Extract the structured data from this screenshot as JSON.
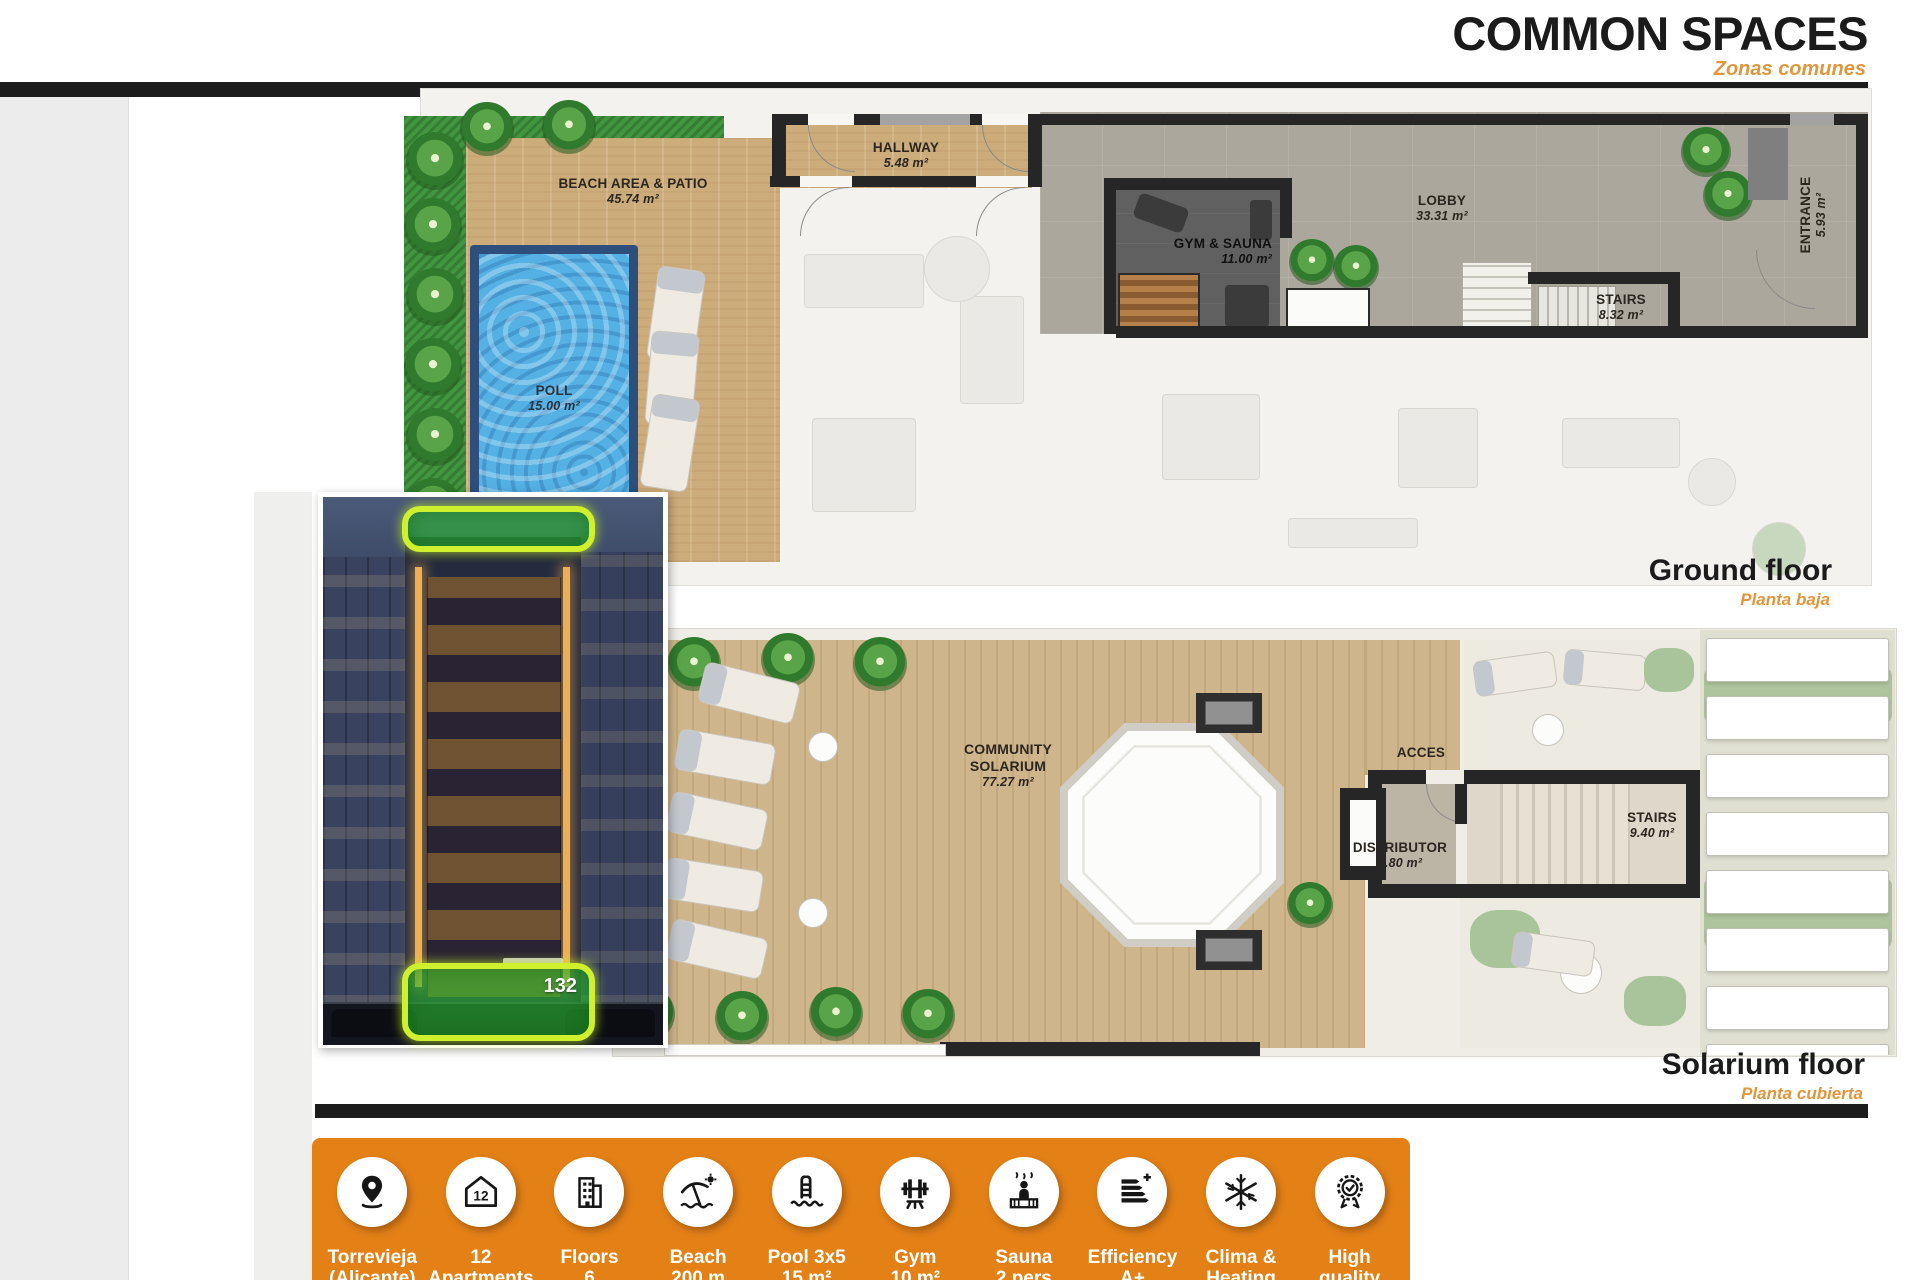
{
  "header": {
    "title": "COMMON SPACES",
    "subtitle": "Zonas comunes"
  },
  "ground_floor": {
    "caption": "Ground floor",
    "caption_es": "Planta baja",
    "rooms": {
      "beach": {
        "name": "BEACH AREA & PATIO",
        "area": "45.74 m²"
      },
      "pool": {
        "name": "POLL",
        "area": "15.00 m²"
      },
      "hallway": {
        "name": "HALLWAY",
        "area": "5.48 m²"
      },
      "gym": {
        "name": "GYM & SAUNA",
        "area": "11.00 m²"
      },
      "lobby": {
        "name": "LOBBY",
        "area": "33.31 m²"
      },
      "stairs": {
        "name": "STAIRS",
        "area": "8.32 m²"
      },
      "entrance": {
        "name": "ENTRANCE",
        "area": "5.93 m²"
      }
    }
  },
  "solarium_floor": {
    "caption": "Solarium floor",
    "caption_es": "Planta cubierta",
    "rooms": {
      "solarium": {
        "name": "COMMUNITY SOLARIUM",
        "area": "77.27 m²"
      },
      "acces": {
        "name": "ACCES"
      },
      "distributor": {
        "name": "DISTRIBUTOR",
        "area": "7.80 m²"
      },
      "stairs": {
        "name": "STAIRS",
        "area": "9.40 m²"
      }
    }
  },
  "photo": {
    "highlight_number": "132"
  },
  "features": [
    {
      "icon": "location-pin-icon",
      "line1": "Torrevieja",
      "line2": "(Alicante)"
    },
    {
      "icon": "apartments-icon",
      "line1": "12",
      "line2": "Apartments"
    },
    {
      "icon": "floors-icon",
      "line1": "Floors",
      "line2": "6"
    },
    {
      "icon": "beach-icon",
      "line1": "Beach",
      "line2": "200 m"
    },
    {
      "icon": "pool-icon",
      "line1": "Pool 3x5",
      "line2": "15 m²"
    },
    {
      "icon": "gym-icon",
      "line1": "Gym",
      "line2": "10 m²"
    },
    {
      "icon": "sauna-icon",
      "line1": "Sauna",
      "line2": "2 pers"
    },
    {
      "icon": "efficiency-icon",
      "line1": "Efficiency",
      "line2": "A+"
    },
    {
      "icon": "climate-icon",
      "line1": "Clima &",
      "line2": "Heating"
    },
    {
      "icon": "quality-icon",
      "line1": "High",
      "line2": "quality"
    }
  ],
  "colors": {
    "accent_orange": "#E38117",
    "title_black": "#1B1B1B",
    "highlight_green": "#3DCC3D",
    "highlight_border": "#D2F12E"
  }
}
